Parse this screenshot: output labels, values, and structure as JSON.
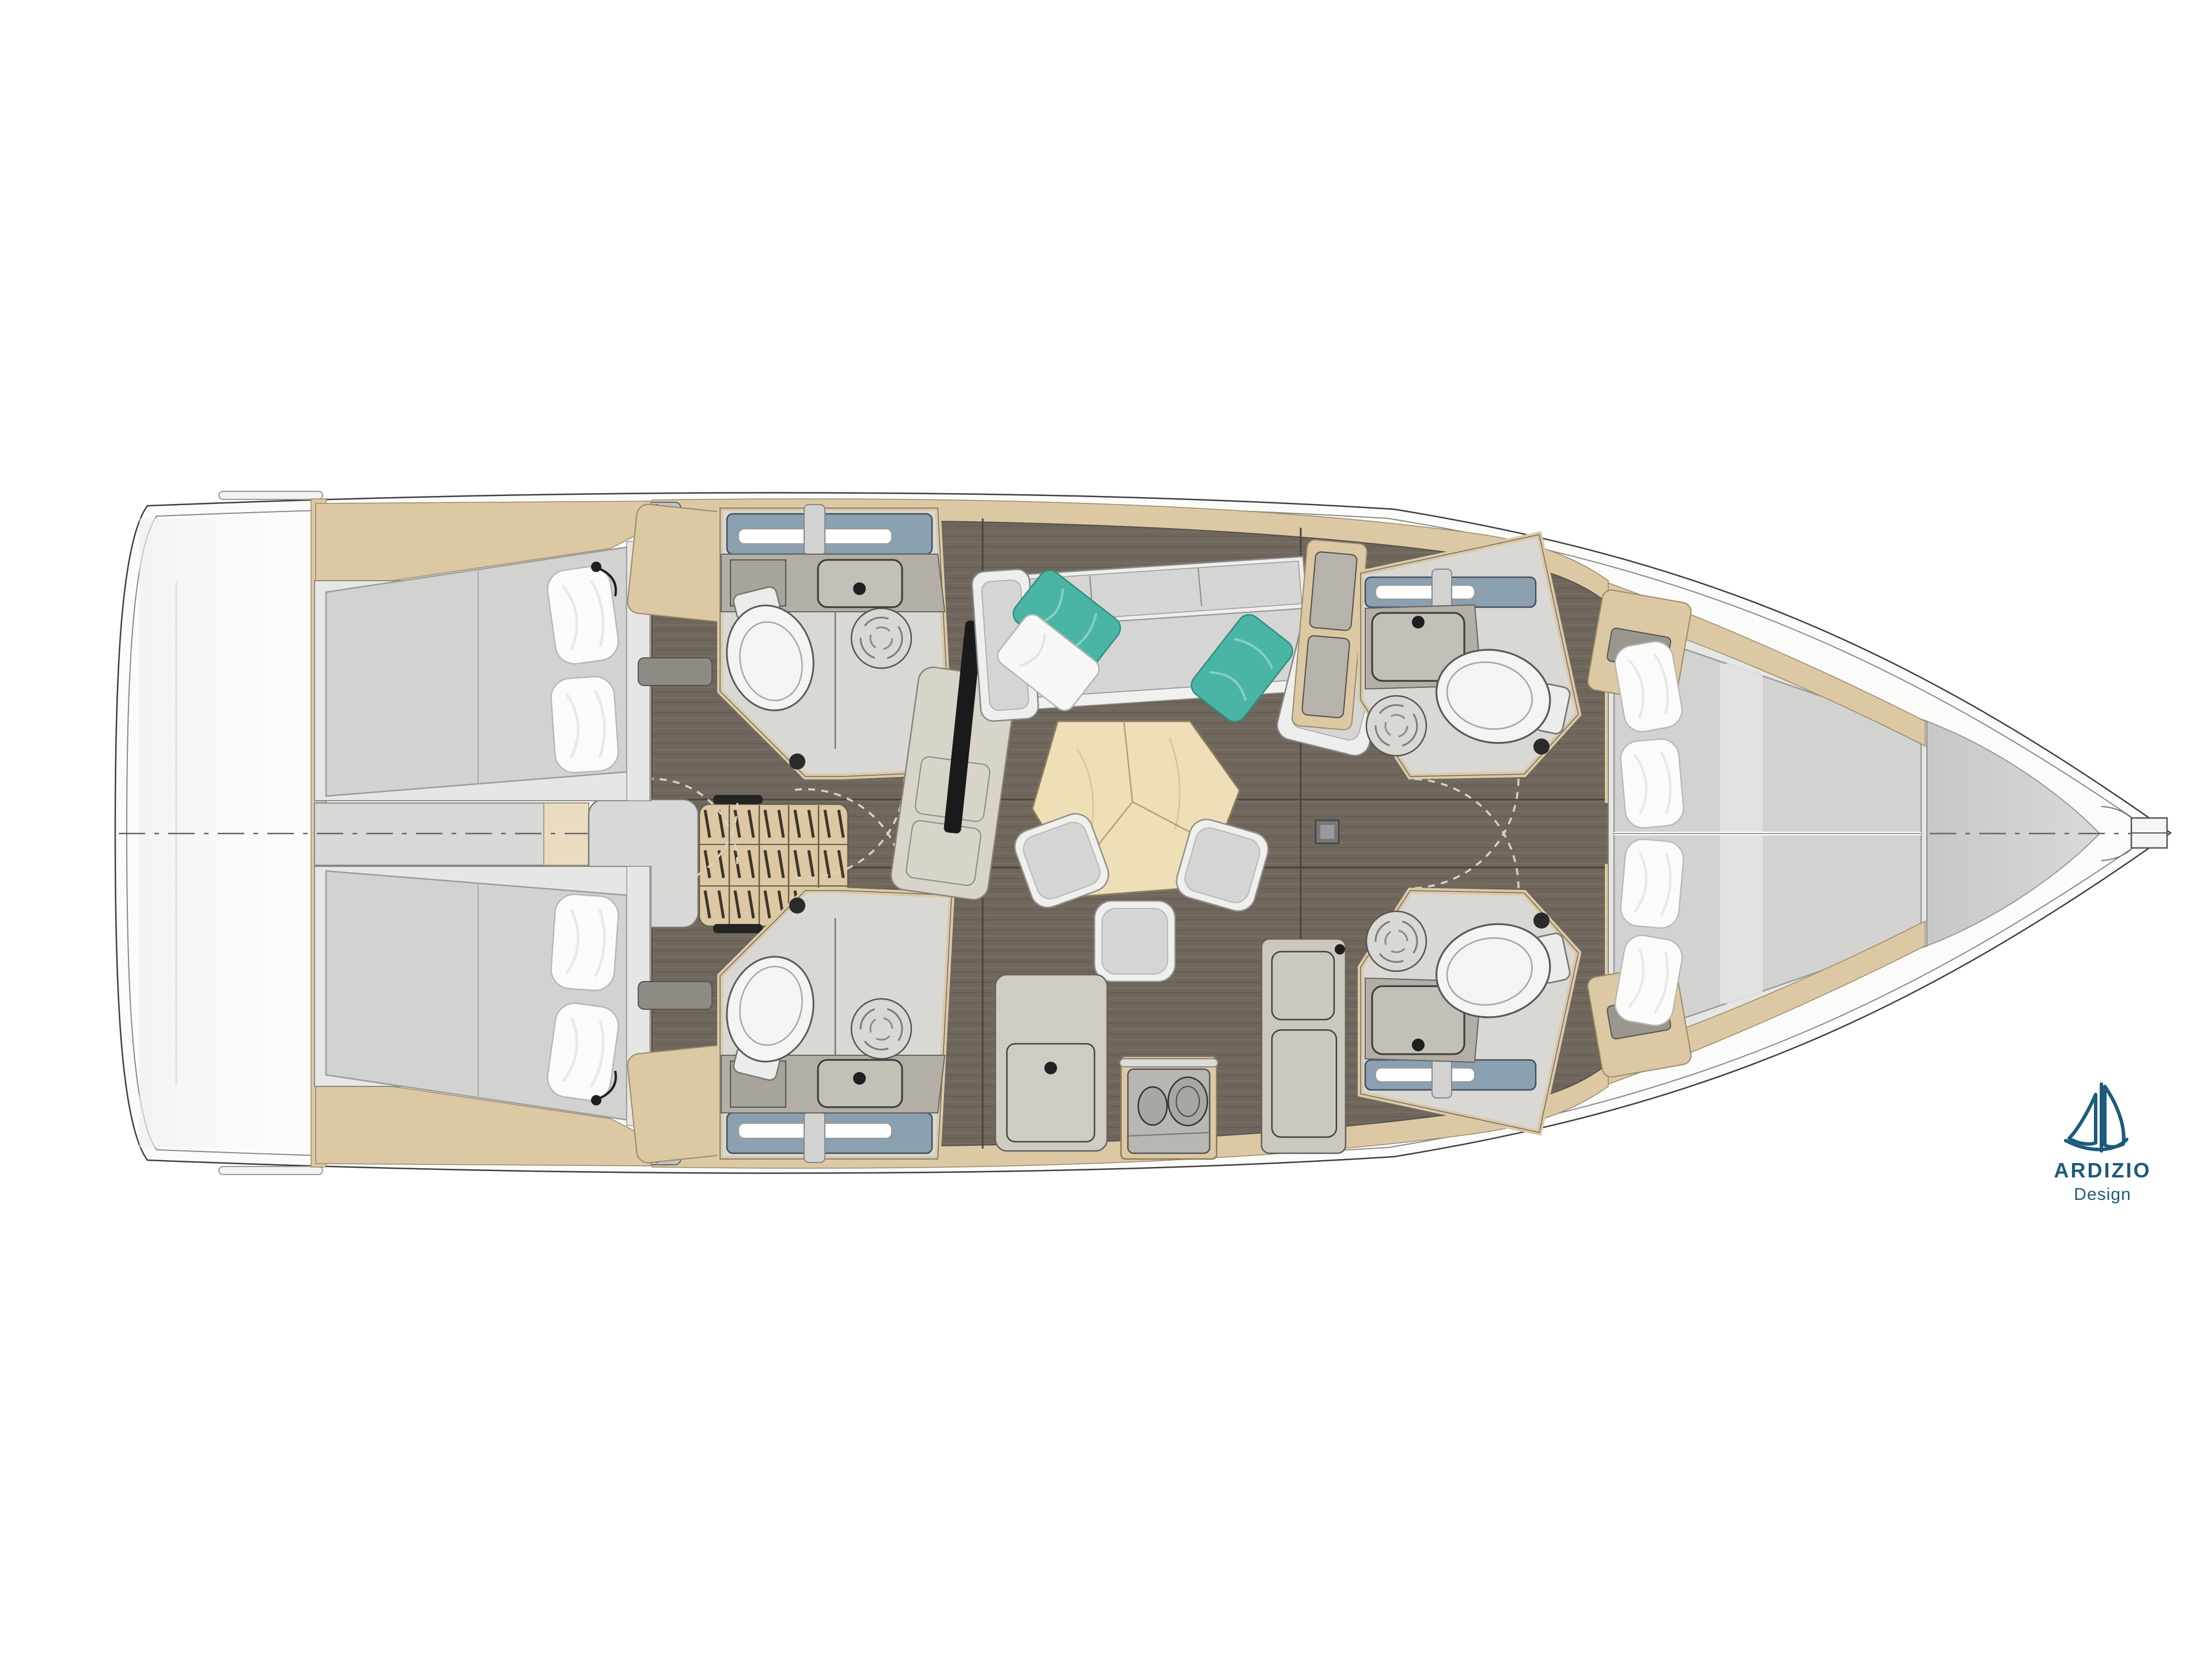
{
  "logo": {
    "brand": "ARDIZIO",
    "tagline": "Design"
  },
  "colors": {
    "page": "#ffffff",
    "navy": "#1d5b7b",
    "hull": "#fbfbfa",
    "stern": "#f4f4f3",
    "line": "#4a4a4a",
    "innerline": "#8a8a8a",
    "wood": "#dcc9a4",
    "wood-light": "#e9dcc0",
    "wood-dark": "#9a8a66",
    "floor": "#6f675c",
    "floor-seam": "#4c453c",
    "panel": "#d8d8d6",
    "mattress": "#d2d2d0",
    "bedframe": "#e6e6e4",
    "pillow": "#fbfbf9",
    "teal": "#4ab5a4",
    "cushion": "#d5d5d3",
    "white-furn": "#eeeeec",
    "counter": "#b3afa6",
    "shower-floor": "#d9d8d4",
    "skylight": "#8ba0b0",
    "tv": "#1a1a1a",
    "bow-deck": "#cbcdcc",
    "table-wood": "#eedfb7",
    "arc": "#d8d3c9",
    "fitting": "#c2c2c0"
  },
  "plan": {
    "type": "sailing-yacht-interior-floor-plan",
    "orientation": {
      "bow": "right",
      "stern": "left",
      "port": "top",
      "starboard": "bottom"
    },
    "counts": {
      "cabins": 3,
      "heads": 4,
      "toilets": 4,
      "berths": 3,
      "saloon_stools": 3
    },
    "rooms": [
      {
        "id": "stern-platform",
        "label": "Stern / transom platform",
        "fixtures": [
          "traveller-track",
          "centerline"
        ]
      },
      {
        "id": "aft-cabin-port",
        "label": "Aft cabin port",
        "fixtures": [
          "double-berth",
          "two-pillows",
          "reading-light",
          "wood-shelf"
        ]
      },
      {
        "id": "aft-cabin-starboard",
        "label": "Aft cabin starboard",
        "fixtures": [
          "double-berth",
          "two-pillows",
          "reading-light",
          "wood-shelf"
        ]
      },
      {
        "id": "companionway",
        "label": "Companionway",
        "fixtures": [
          "wooden-steps",
          "landing-platform",
          "windlass-fitting"
        ]
      },
      {
        "id": "aft-head-port",
        "label": "Aft head port",
        "fixtures": [
          "toilet",
          "washbasin",
          "shower-drain",
          "skylight",
          "led-light",
          "door-swing"
        ]
      },
      {
        "id": "aft-head-starboard",
        "label": "Aft head starboard",
        "fixtures": [
          "toilet",
          "washbasin",
          "shower-drain",
          "skylight",
          "led-light",
          "door-swing"
        ]
      },
      {
        "id": "saloon",
        "label": "Saloon",
        "fixtures": [
          "u-shaped-sofa",
          "teal-pillow-left",
          "white-pillow",
          "teal-pillow-right",
          "chaise-seat",
          "tv-panel",
          "locker-cabinet",
          "pentagon-dining-table",
          "three-stools"
        ]
      },
      {
        "id": "galley",
        "label": "Galley",
        "fixtures": [
          "l-counter",
          "access-hatch",
          "two-burner-stove",
          "handrail",
          "side-counter",
          "faucet"
        ]
      },
      {
        "id": "forward-head-port",
        "label": "Forward head port",
        "fixtures": [
          "toilet",
          "washbasin",
          "shower-drain",
          "skylight",
          "led-light",
          "door-swing"
        ]
      },
      {
        "id": "forward-head-starboard",
        "label": "Forward head starboard",
        "fixtures": [
          "toilet",
          "washbasin",
          "shower-drain",
          "skylight",
          "led-light",
          "door-swing"
        ]
      },
      {
        "id": "forward-cabin",
        "label": "Forward cabin",
        "fixtures": [
          "v-berth",
          "four-pillows",
          "vanity-desk",
          "wood-trim"
        ]
      },
      {
        "id": "foredeck",
        "label": "Foredeck / bow",
        "fixtures": [
          "anchor-fitting",
          "centerline"
        ]
      }
    ],
    "other_symbols": [
      "mast-post",
      "door-swing-arcs",
      "centerline-dash-dot",
      "floor-plank-seams"
    ]
  }
}
